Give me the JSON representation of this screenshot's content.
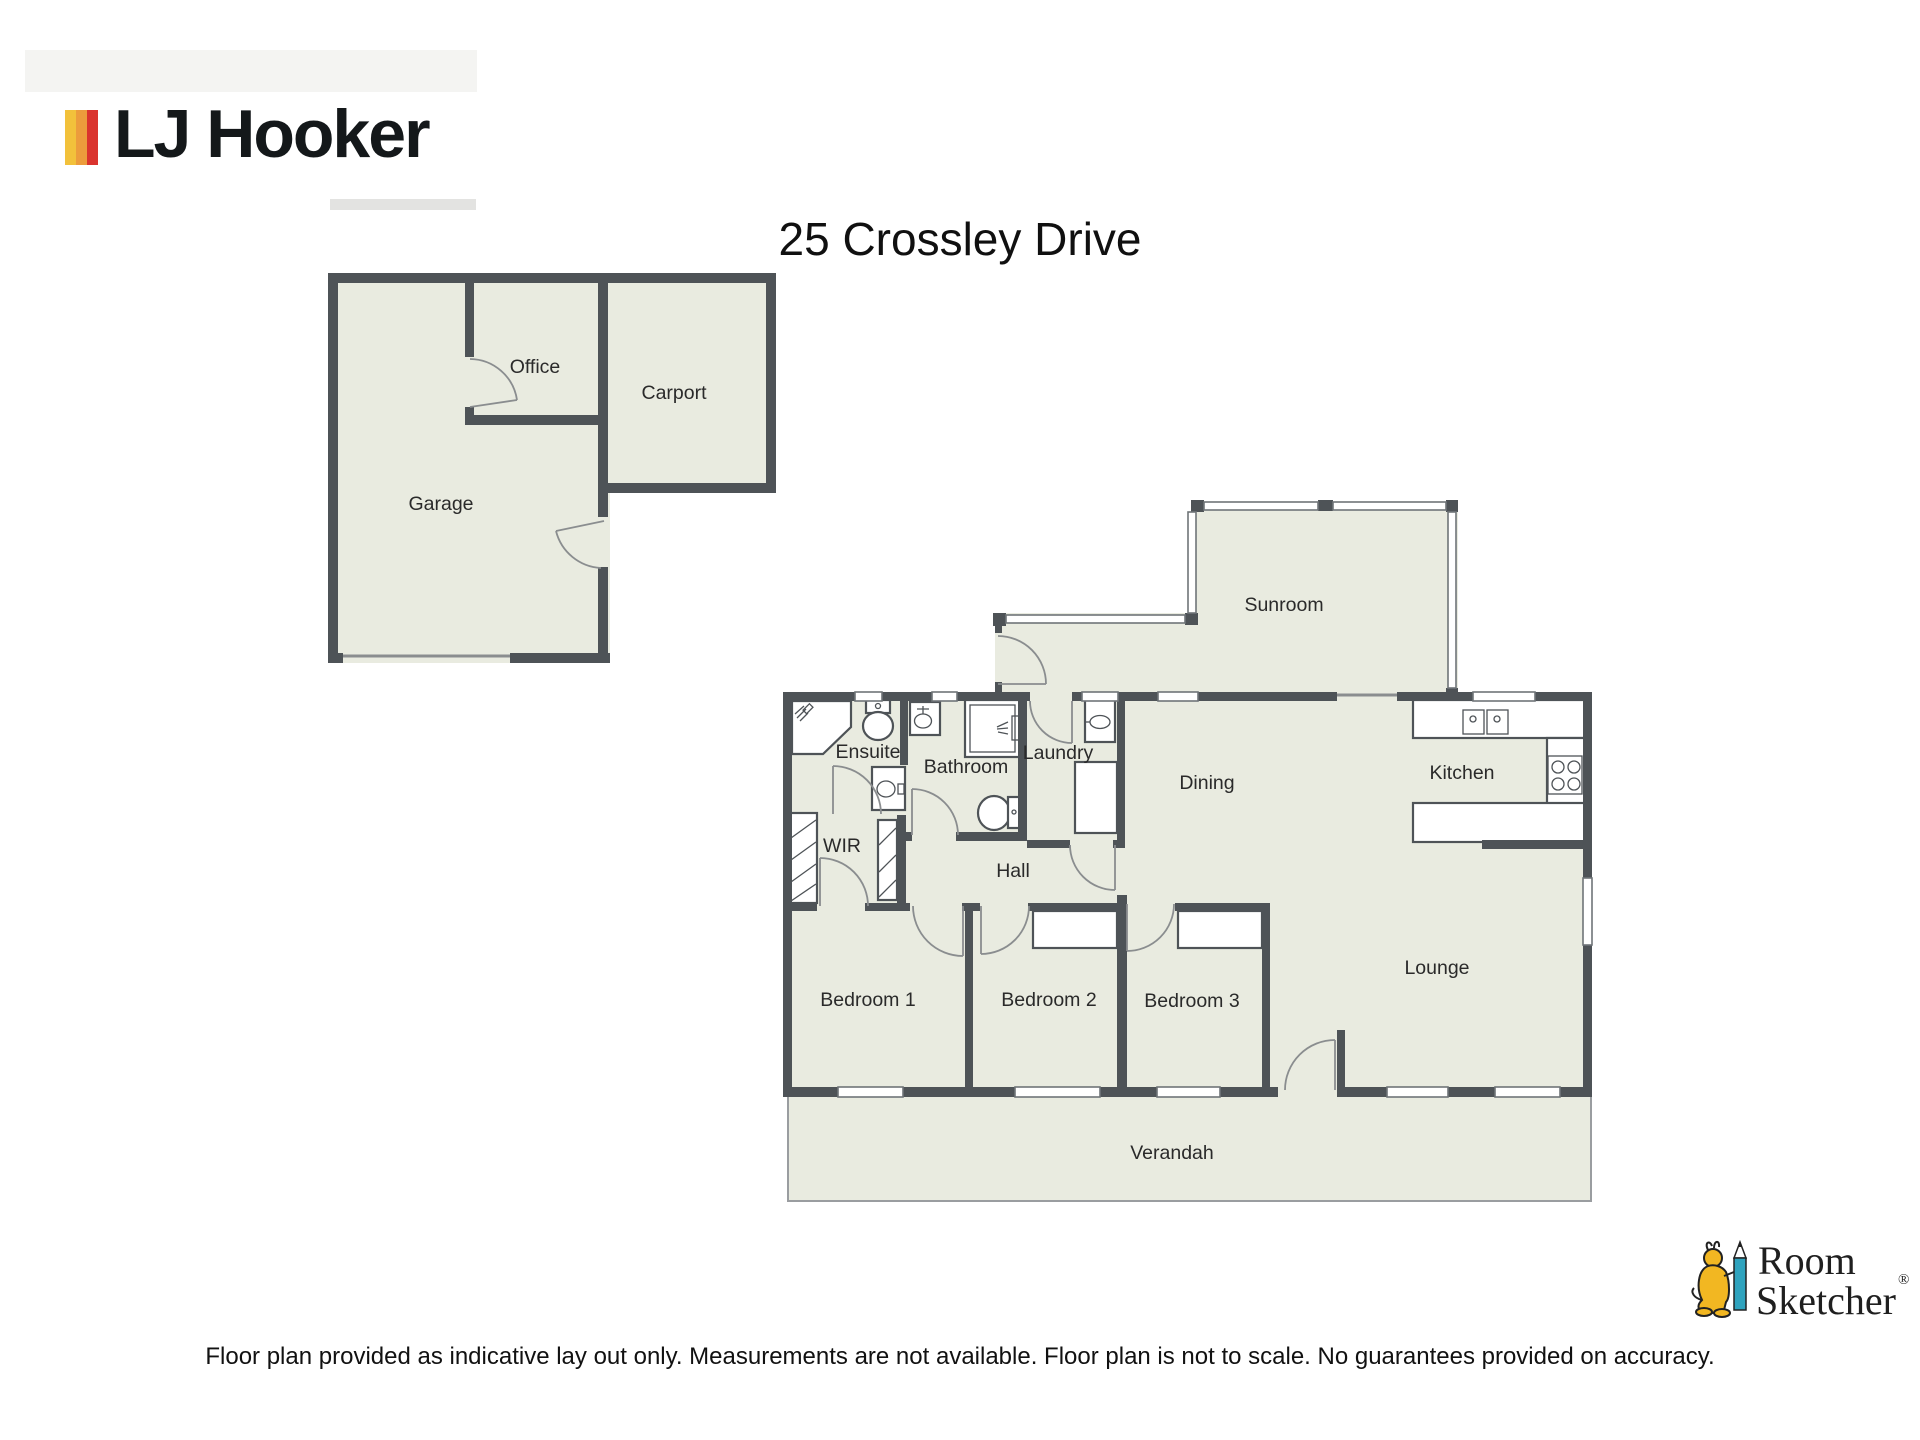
{
  "header": {
    "brand": "LJ Hooker",
    "title": "25 Crossley Drive"
  },
  "rooms": [
    {
      "id": "garage",
      "label": "Garage"
    },
    {
      "id": "office",
      "label": "Office"
    },
    {
      "id": "carport",
      "label": "Carport"
    },
    {
      "id": "sunroom",
      "label": "Sunroom"
    },
    {
      "id": "ensuite",
      "label": "Ensuite"
    },
    {
      "id": "bathroom",
      "label": "Bathroom"
    },
    {
      "id": "laundry",
      "label": "Laundry"
    },
    {
      "id": "dining",
      "label": "Dining"
    },
    {
      "id": "kitchen",
      "label": "Kitchen"
    },
    {
      "id": "wir",
      "label": "WIR"
    },
    {
      "id": "hall",
      "label": "Hall"
    },
    {
      "id": "bedroom1",
      "label": "Bedroom 1"
    },
    {
      "id": "bedroom2",
      "label": "Bedroom 2"
    },
    {
      "id": "bedroom3",
      "label": "Bedroom 3"
    },
    {
      "id": "lounge",
      "label": "Lounge"
    },
    {
      "id": "verandah",
      "label": "Verandah"
    }
  ],
  "footer": {
    "disclaimer": "Floor plan provided as indicative lay out only. Measurements are not available. Floor plan is not to scale. No guarantees provided on accuracy.",
    "rs_line1": "Room",
    "rs_line2": "Sketcher",
    "registered_mark": "®"
  },
  "colors": {
    "brand_yellow": "#F2C13B",
    "brand_orange": "#EC9C3C",
    "brand_red": "#DA342E",
    "wall": "#4E5357",
    "floor_fill": "#E9EBE0",
    "rs_pencil_teal": "#2FA3BE",
    "rs_character_yellow": "#F2B722"
  }
}
